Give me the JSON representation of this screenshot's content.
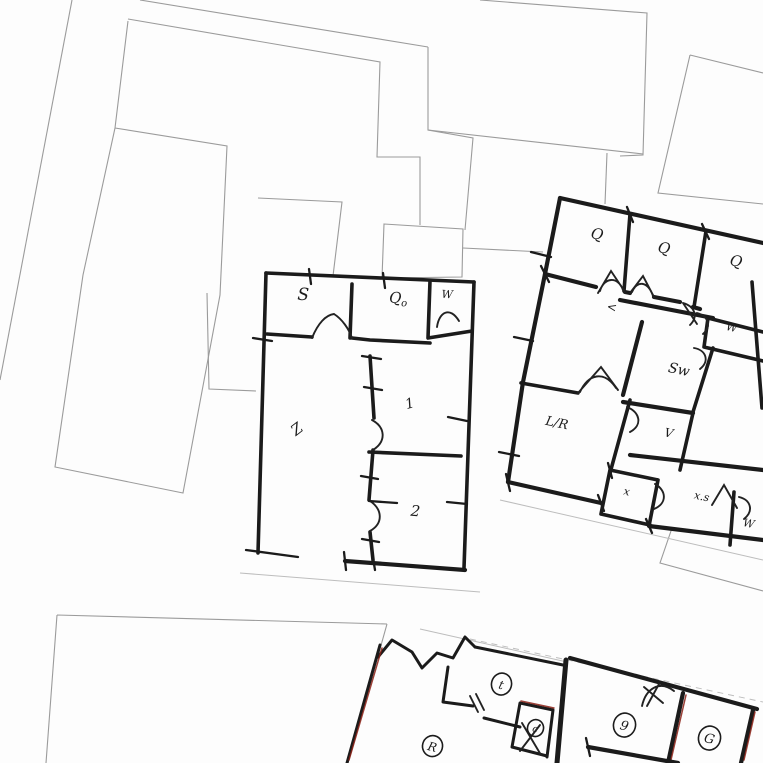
{
  "scene": {
    "description": "Scanned hand-drawn floor plan sketches over faint cadastral parcel outlines",
    "colors": {
      "paper": "#fdfdfd",
      "parcel_line": "#9b9b9b",
      "wall_ink": "#1b1b1b",
      "accent_red": "#8a2015"
    }
  },
  "plans": {
    "left": {
      "rooms": {
        "s": "S",
        "qo_main": "Q",
        "qo_sub": "o",
        "w": "W",
        "z": "Z",
        "one": "1",
        "two": "2"
      }
    },
    "right": {
      "rooms": {
        "q1": "Q",
        "q2": "Q",
        "q3": "Q",
        "hall": "<",
        "w_upper": "W",
        "sw": "Sw",
        "v": "V",
        "lr": "L/R",
        "x": "x",
        "xs": "x.s",
        "w_lower": "W"
      }
    },
    "bottom": {
      "rooms": {
        "t": "t",
        "c": "c",
        "r": "R",
        "nine": "9",
        "g": "G"
      }
    }
  }
}
